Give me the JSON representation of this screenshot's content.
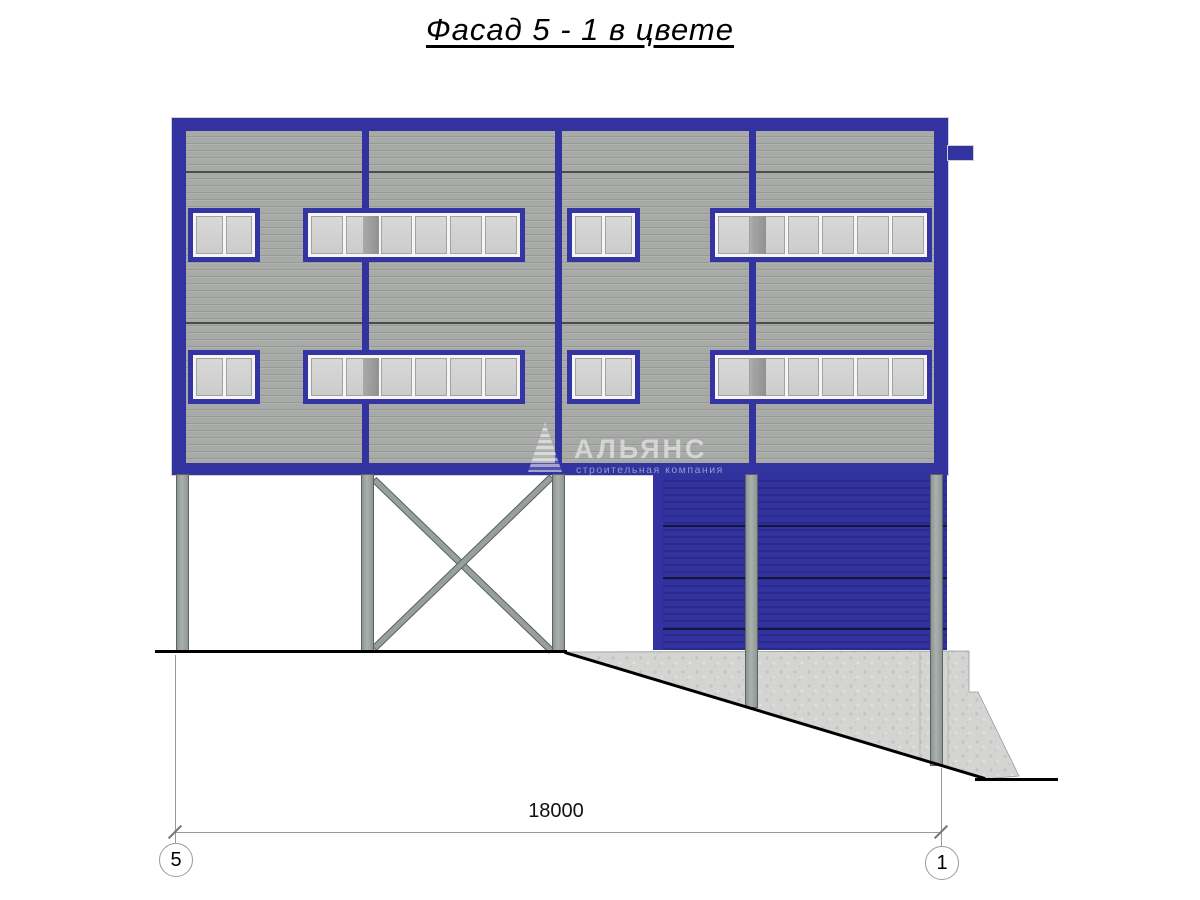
{
  "title": "Фасад 5 - 1 в цвете",
  "watermark": {
    "name": "АЛЬЯНС",
    "tagline": "строительная компания"
  },
  "dimension": {
    "total_width_mm": "18000"
  },
  "axis_markers": {
    "left": "5",
    "right": "1"
  },
  "colors": {
    "frame_blue": "#3333a0",
    "gate_blue": "#32329e",
    "cladding_gray": "#a8aaa8",
    "column_gray": "#98a09e",
    "concrete_gray": "#d4d4d2",
    "window_pane_gray": "#d2d2d2"
  }
}
